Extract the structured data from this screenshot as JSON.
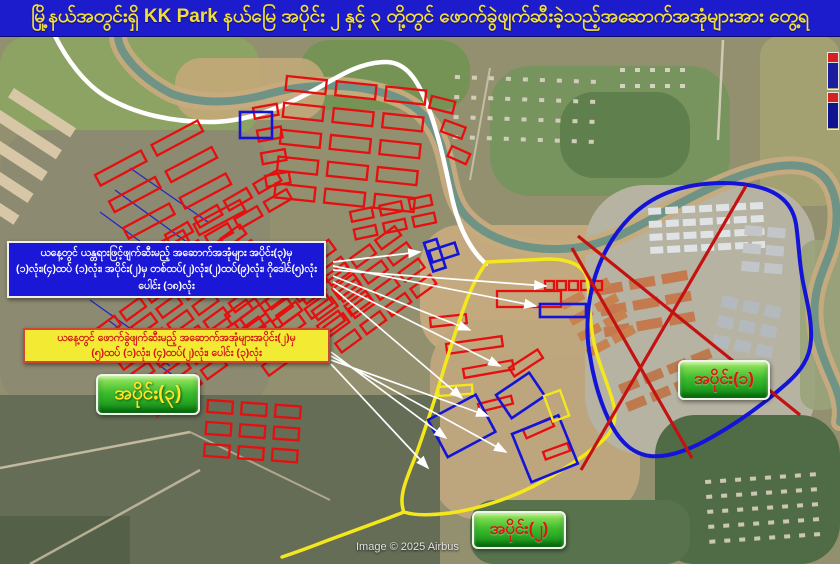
{
  "title_bar": {
    "text": "မြို့နယ်အတွင်းရှိ  KK Park နယ်မြေ အပိုင်း ၂ နှင့် ၃ တို့တွင် ဖောက်ခွဲဖျက်ဆီးခဲ့သည့်အဆောက်အအုံများအား တွေ့ရ",
    "bg": "#1c1ccd",
    "text_color": "#f2de3a"
  },
  "blue_box": {
    "lines": [
      "ယနေ့တွင် ယန္တရားဖြင့်ဖျက်ဆီးမည့် အဆောက်အအုံများ အပိုင်း(၃)မှ",
      "(၁)လုံး၊(၄)ထပ် (၁)လုံး၊ အပိုင်း(၂)မှ တစ်ထပ်(၂)လုံး၊(၂)ထပ်(၉)လုံး၊ ဂိုဒေါင်(၅)လုံး",
      "ပေါင်း (၁၈)လုံး"
    ]
  },
  "yellow_box": {
    "lines": [
      "ယနေ့တွင် ဖောက်ခွဲဖျက်ဆီးမည့် အဆောက်အအုံများအပိုင်း(၂)မှ",
      "(၅)ထပ် (၁)လုံး၊ (၄)ထပ်(၂)လုံး၊ ပေါင်း (၃)လုံး"
    ]
  },
  "zone_labels": [
    {
      "id": "zone-3",
      "text": "အပိုင်း(၃)",
      "text_color": "#ffe427"
    },
    {
      "id": "zone-2",
      "text": "အပိုင်း(၂)",
      "text_color": "#e01313"
    },
    {
      "id": "zone-1",
      "text": "အပိုင်း(၁)",
      "text_color": "#e01313"
    }
  ],
  "attribution": "Image © 2025 Airbus",
  "map": {
    "colors": {
      "annotation_red": "#e60f0f",
      "annotation_blue": "#1414d8",
      "annotation_yellow": "#f4e81c",
      "river_bank": "#c6ab7e",
      "river_water": "#6f9486"
    },
    "terrain": [
      [
        0,
        36,
        840,
        528,
        0,
        "#93906f",
        1
      ],
      [
        0,
        36,
        260,
        100,
        30,
        "#8da562",
        0.9
      ],
      [
        300,
        40,
        170,
        70,
        30,
        "#6f9450",
        0.85
      ],
      [
        175,
        58,
        150,
        62,
        26,
        "#c2a878",
        0.9
      ],
      [
        490,
        66,
        240,
        130,
        40,
        "#74945c",
        0.9
      ],
      [
        560,
        92,
        130,
        86,
        34,
        "#5c7d4a",
        0.9
      ],
      [
        760,
        36,
        80,
        170,
        20,
        "#a5a271",
        0.9
      ],
      [
        0,
        130,
        270,
        280,
        40,
        "#8b8a70",
        0.95
      ],
      [
        420,
        225,
        220,
        130,
        40,
        "#c6ab80",
        0.95
      ],
      [
        430,
        320,
        210,
        200,
        50,
        "#bfa67d",
        0.95
      ],
      [
        585,
        185,
        230,
        270,
        60,
        "#b6b3a3",
        1
      ],
      [
        655,
        415,
        185,
        149,
        40,
        "#506c46",
        1
      ],
      [
        470,
        500,
        220,
        64,
        24,
        "#57724c",
        1
      ],
      [
        0,
        395,
        440,
        169,
        0,
        "#656d56",
        1
      ],
      [
        0,
        516,
        130,
        48,
        0,
        "#495840",
        0.6
      ],
      [
        800,
        240,
        40,
        170,
        16,
        "#9aa37b",
        0.9
      ]
    ],
    "dirt_roads": [
      [
        0,
        468,
        190,
        432,
        2.5,
        "#cdc2a6",
        0.9
      ],
      [
        30,
        564,
        200,
        470,
        2.5,
        "#cdc2a6",
        0.8
      ],
      [
        190,
        432,
        330,
        500,
        2,
        "#cdc2a6",
        0.7
      ],
      [
        723,
        40,
        718,
        140,
        2.5,
        "#d8d0ba",
        0.9
      ],
      [
        490,
        68,
        470,
        180,
        2,
        "#d8d0ba",
        0.7
      ]
    ],
    "river_path": "M 118 36 C 118 52 140 78 172 94 C 200 104 232 104 268 94 C 300 85 342 82 380 92 C 412 100 430 116 440 142 C 450 168 448 194 464 214 C 486 240 528 253 574 248 C 622 242 652 216 698 194 C 734 176 776 160 806 167 C 830 173 839 196 836 226 C 833 256 818 272 815 302 C 812 332 822 356 833 381 C 841 399 842 412 840 422",
    "road_path": "M 55 36 C 66 58 84 84 108 98 C 136 114 172 122 210 122 C 248 122 286 106 318 88 C 342 74 362 62 386 62 C 408 62 420 84 430 112 C 440 140 446 170 452 198 C 458 224 468 248 486 264",
    "filled_clusters": [
      {
        "x": 648,
        "y": 208,
        "rows": 4,
        "cols": 7,
        "w": 13,
        "h": 7,
        "gx": 4,
        "gy": 6,
        "a": -3,
        "fill": "#dfe3e6"
      },
      {
        "x": 596,
        "y": 286,
        "rows": 3,
        "cols": 3,
        "w": 26,
        "h": 10,
        "gx": 7,
        "gy": 11,
        "a": -10,
        "fill": "#c4794e"
      },
      {
        "x": 723,
        "y": 295,
        "rows": 3,
        "cols": 3,
        "w": 16,
        "h": 12,
        "gx": 6,
        "gy": 8,
        "a": 12,
        "fill": "#b3b9bd"
      },
      {
        "x": 618,
        "y": 385,
        "rows": 2,
        "cols": 4,
        "w": 20,
        "h": 10,
        "gx": 6,
        "gy": 9,
        "a": -22,
        "fill": "#bd7a4e"
      },
      {
        "x": 560,
        "y": 302,
        "rows": 4,
        "cols": 2,
        "w": 24,
        "h": 9,
        "gx": 5,
        "gy": 9,
        "a": -28,
        "fill": "#c8824f"
      },
      {
        "x": 14,
        "y": 88,
        "rows": 5,
        "cols": 1,
        "w": 74,
        "h": 11,
        "gx": 0,
        "gy": 15,
        "a": 33,
        "fill": "#d8c7a7"
      },
      {
        "x": 455,
        "y": 75,
        "rows": 4,
        "cols": 9,
        "w": 5,
        "h": 4,
        "gx": 12,
        "gy": 16,
        "a": 2,
        "fill": "#d2ccba"
      },
      {
        "x": 620,
        "y": 68,
        "rows": 2,
        "cols": 5,
        "w": 5,
        "h": 4,
        "gx": 10,
        "gy": 12,
        "a": 0,
        "fill": "#d7d1c1"
      },
      {
        "x": 705,
        "y": 480,
        "rows": 5,
        "cols": 8,
        "w": 6,
        "h": 4,
        "gx": 9,
        "gy": 11,
        "a": -4,
        "fill": "#ccc6b5"
      },
      {
        "x": 745,
        "y": 225,
        "rows": 3,
        "cols": 2,
        "w": 18,
        "h": 10,
        "gx": 5,
        "gy": 8,
        "a": 5,
        "fill": "#c2c6c9"
      }
    ],
    "hatch_lines": [
      [
        130,
        168,
        208,
        222
      ],
      [
        115,
        190,
        195,
        248
      ],
      [
        100,
        212,
        182,
        272
      ],
      [
        90,
        300,
        152,
        344
      ],
      [
        108,
        320,
        170,
        366
      ],
      [
        128,
        342,
        190,
        388
      ]
    ],
    "red_clusters": [
      {
        "x": 287,
        "y": 76,
        "rows": 5,
        "cols": 3,
        "w": 40,
        "h": 14,
        "gx": 10,
        "gy": 13,
        "a": 6
      },
      {
        "x": 95,
        "y": 175,
        "rows": 4,
        "cols": 2,
        "w": 52,
        "h": 12,
        "gx": 12,
        "gy": 18,
        "a": -28
      },
      {
        "x": 95,
        "y": 330,
        "rows": 6,
        "cols": 6,
        "w": 24,
        "h": 11,
        "gx": 7,
        "gy": 8,
        "a": -36
      },
      {
        "x": 225,
        "y": 315,
        "rows": 4,
        "cols": 4,
        "w": 26,
        "h": 12,
        "gx": 8,
        "gy": 9,
        "a": -36
      },
      {
        "x": 300,
        "y": 295,
        "rows": 4,
        "cols": 4,
        "w": 24,
        "h": 11,
        "gx": 7,
        "gy": 9,
        "a": -36
      },
      {
        "x": 208,
        "y": 400,
        "rows": 3,
        "cols": 3,
        "w": 25,
        "h": 12,
        "gx": 9,
        "gy": 10,
        "a": 4
      },
      {
        "x": 253,
        "y": 108,
        "rows": 4,
        "cols": 1,
        "w": 24,
        "h": 11,
        "gx": 0,
        "gy": 12,
        "a": -10
      },
      {
        "x": 165,
        "y": 235,
        "rows": 2,
        "cols": 4,
        "w": 26,
        "h": 11,
        "gx": 8,
        "gy": 10,
        "a": -30
      },
      {
        "x": 350,
        "y": 212,
        "rows": 2,
        "cols": 3,
        "w": 22,
        "h": 10,
        "gx": 8,
        "gy": 8,
        "a": -12
      },
      {
        "x": 545,
        "y": 281,
        "rows": 1,
        "cols": 5,
        "w": 9,
        "h": 9,
        "gx": 3,
        "gy": 0,
        "a": 0
      }
    ],
    "red_rects": [
      [
        497,
        291,
        64,
        16,
        0
      ],
      [
        430,
        318,
        36,
        9,
        -6
      ],
      [
        446,
        344,
        56,
        10,
        -8
      ],
      [
        463,
        369,
        50,
        9,
        -10
      ],
      [
        509,
        368,
        34,
        10,
        -33
      ],
      [
        478,
        404,
        34,
        8,
        -14
      ],
      [
        523,
        430,
        30,
        9,
        -24
      ],
      [
        543,
        452,
        26,
        8,
        -20
      ],
      [
        432,
        96,
        24,
        12,
        14
      ],
      [
        445,
        120,
        22,
        12,
        20
      ],
      [
        452,
        146,
        20,
        11,
        24
      ]
    ],
    "zone2_boundary": "M 487 262 L 548 259 C 570 259 584 266 587 278 C 590 295 589 315 593 338 C 597 360 606 378 613 402 C 618 420 612 433 601 442 C 585 456 560 472 534 486 C 508 499 478 509 450 513 C 432 515 416 516 404 512 C 398 498 406 480 414 460 C 423 436 430 414 437 392 C 444 368 452 342 461 316 C 468 295 476 276 487 262 Z",
    "zone2_tail": "M 404 512 C 384 520 356 530 326 541 C 308 548 294 553 282 557",
    "zone1_boundary": "M 588 314 C 590 288 598 262 612 240 C 626 218 646 200 672 191 C 698 182 734 180 762 188 C 782 194 793 206 796 224 C 799 244 799 262 803 282 C 807 302 812 320 811 340 C 810 358 801 371 786 384 C 768 400 742 420 714 436 C 690 450 668 458 650 456 C 634 454 622 444 612 426 C 602 408 594 382 590 356 C 587 340 587 328 588 314 Z",
    "red_cross_lines": [
      [
        578,
        236,
        800,
        415
      ],
      [
        746,
        186,
        581,
        470
      ],
      [
        572,
        248,
        692,
        458
      ]
    ],
    "blue_rects": [
      [
        240,
        112,
        32,
        26,
        0
      ],
      [
        424,
        243,
        13,
        30,
        -18
      ],
      [
        429,
        251,
        27,
        12,
        -18
      ],
      [
        540,
        304,
        46,
        13,
        0
      ],
      [
        496,
        395,
        40,
        28,
        -34
      ],
      [
        428,
        420,
        54,
        42,
        -28
      ],
      [
        512,
        434,
        50,
        52,
        -22
      ]
    ],
    "yellow_rects": [
      [
        544,
        396,
        17,
        27,
        -20
      ],
      [
        438,
        387,
        34,
        9,
        -4
      ]
    ],
    "arrows": [
      [
        333,
        262,
        420,
        252
      ],
      [
        333,
        266,
        536,
        306
      ],
      [
        333,
        270,
        546,
        286
      ],
      [
        333,
        276,
        470,
        330
      ],
      [
        333,
        282,
        500,
        366
      ],
      [
        333,
        288,
        462,
        398
      ],
      [
        331,
        352,
        446,
        438
      ],
      [
        331,
        356,
        506,
        452
      ],
      [
        331,
        360,
        488,
        416
      ],
      [
        331,
        364,
        428,
        468
      ]
    ]
  }
}
